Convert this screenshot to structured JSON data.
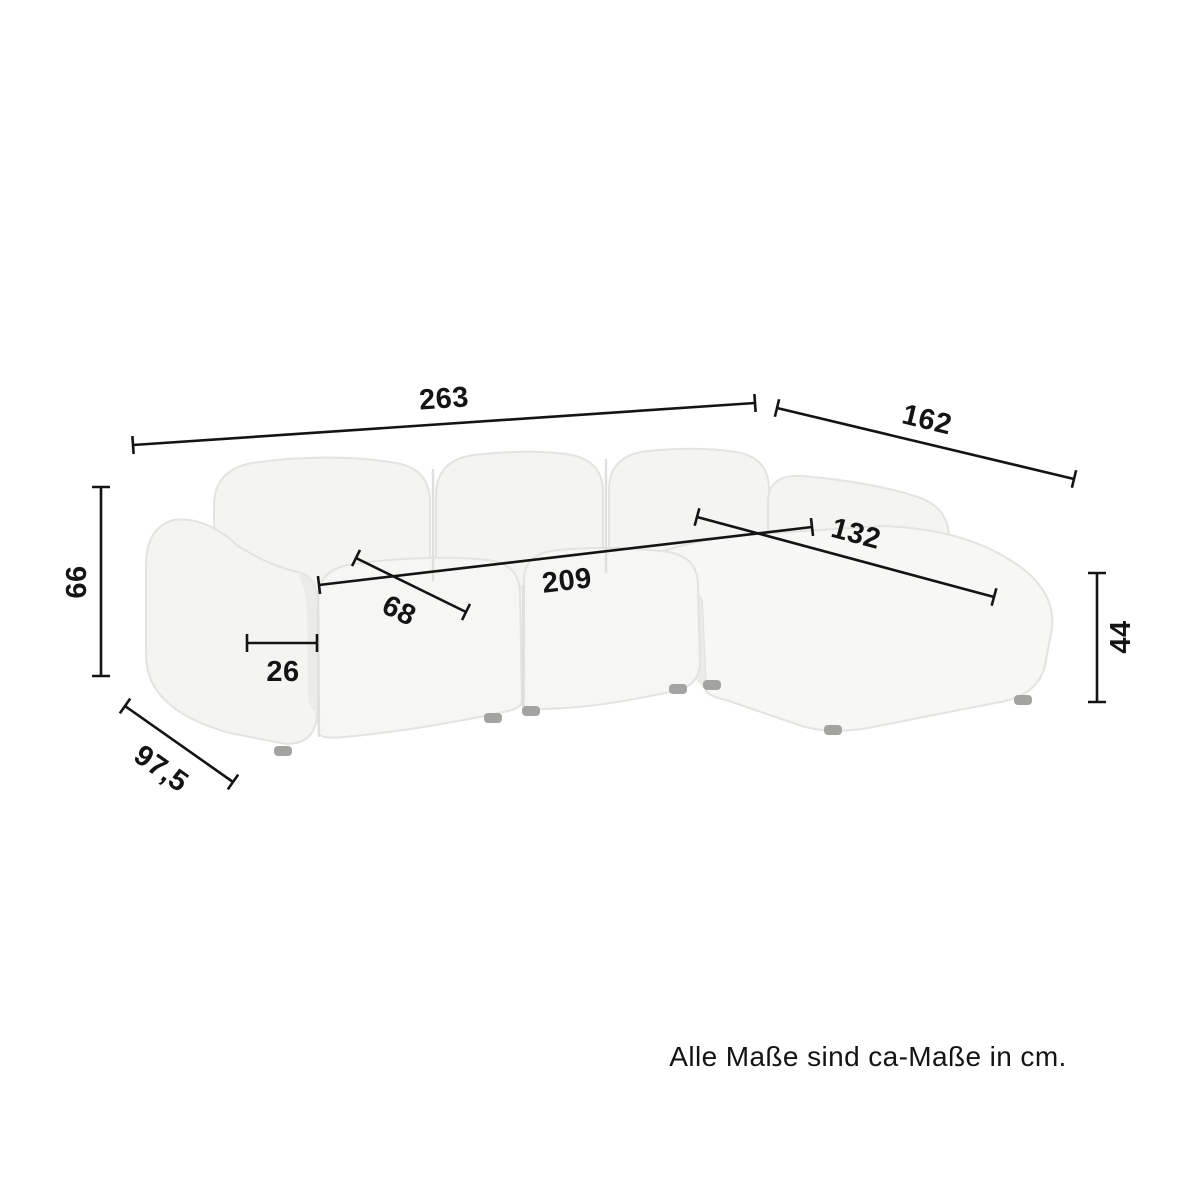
{
  "dims": {
    "total_width": "263",
    "chaise_total_depth": "162",
    "back_height": "66",
    "total_depth": "97,5",
    "armrest_width": "26",
    "seat_depth": "68",
    "inner_seat_width": "209",
    "chaise_length": "132",
    "seat_height": "44"
  },
  "note": "Alle Maße sind ca-Maße in cm.",
  "colors": {
    "background": "#ffffff",
    "line": "#141414",
    "text": "#141414",
    "sofa_base": "#f4f4f2",
    "sofa_top": "#f7f7f5",
    "sofa_front": "#f6f6f4",
    "sofa_shade": "#ebebe8",
    "sofa_seam": "#dfdfdc",
    "feet": "#a3a3a1"
  }
}
